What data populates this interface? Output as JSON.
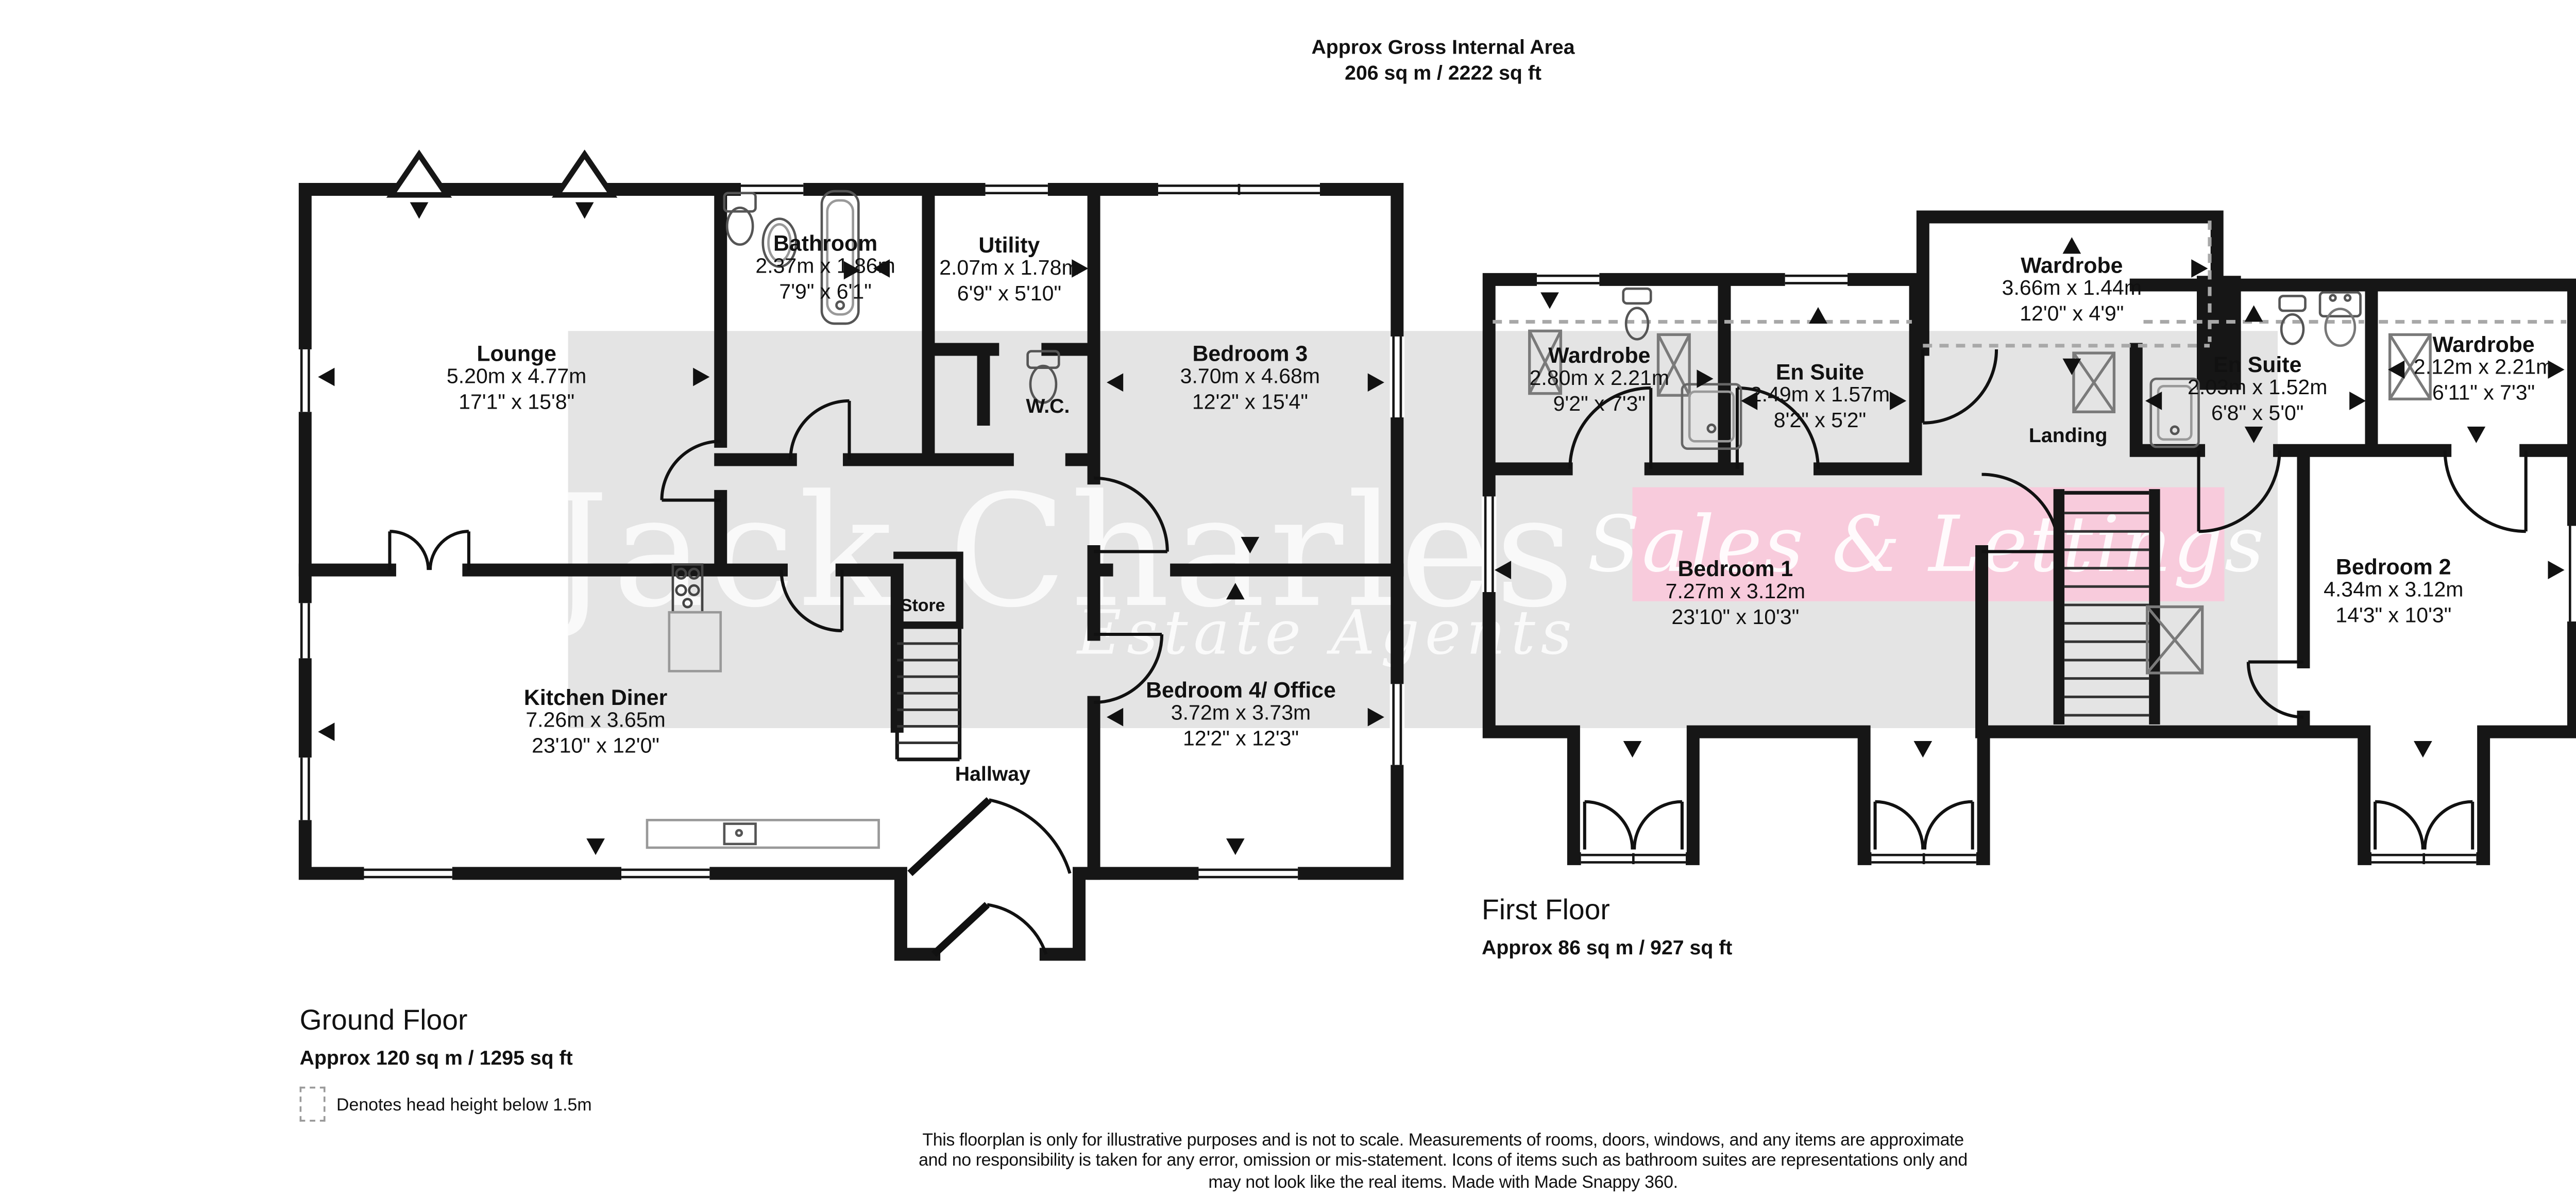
{
  "header": {
    "line1": "Approx Gross Internal Area",
    "line2": "206 sq m / 2222 sq ft"
  },
  "compass": {
    "n": "N",
    "e": "E",
    "s": "S",
    "w": "W"
  },
  "watermark": {
    "brand": "Jack Charles",
    "sub": "Estate Agents",
    "banner": "Sales & Lettings"
  },
  "ground_floor": {
    "title": "Ground Floor",
    "area": "Approx 120 sq m / 1295 sq ft",
    "rooms": {
      "lounge": {
        "name": "Lounge",
        "metric": "5.20m x 4.77m",
        "imperial": "17'1\" x 15'8\""
      },
      "bathroom": {
        "name": "Bathroom",
        "metric": "2.37m x 1.86m",
        "imperial": "7'9\" x 6'1\""
      },
      "utility": {
        "name": "Utility",
        "metric": "2.07m x 1.78m",
        "imperial": "6'9\" x 5'10\""
      },
      "wc": {
        "name": "W.C."
      },
      "bedroom3": {
        "name": "Bedroom 3",
        "metric": "3.70m x 4.68m",
        "imperial": "12'2\" x 15'4\""
      },
      "kitchen": {
        "name": "Kitchen Diner",
        "metric": "7.26m x 3.65m",
        "imperial": "23'10\" x 12'0\""
      },
      "store": {
        "name": "Store"
      },
      "hallway": {
        "name": "Hallway"
      },
      "bedroom4": {
        "name": "Bedroom 4/ Office",
        "metric": "3.72m x 3.73m",
        "imperial": "12'2\" x 12'3\""
      }
    }
  },
  "first_floor": {
    "title": "First Floor",
    "area": "Approx 86 sq m / 927 sq ft",
    "rooms": {
      "wardrobe_left": {
        "name": "Wardrobe",
        "metric": "2.80m x 2.21m",
        "imperial": "9'2\" x 7'3\""
      },
      "ensuite_left": {
        "name": "En Suite",
        "metric": "2.49m x 1.57m",
        "imperial": "8'2\" x 5'2\""
      },
      "wardrobe_top": {
        "name": "Wardrobe",
        "metric": "3.66m x 1.44m",
        "imperial": "12'0\" x 4'9\""
      },
      "landing": {
        "name": "Landing"
      },
      "ensuite_right": {
        "name": "En Suite",
        "metric": "2.03m x 1.52m",
        "imperial": "6'8\" x 5'0\""
      },
      "wardrobe_right": {
        "name": "Wardrobe",
        "metric": "2.12m x 2.21m",
        "imperial": "6'11\" x 7'3\""
      },
      "bedroom1": {
        "name": "Bedroom 1",
        "metric": "7.27m x 3.12m",
        "imperial": "23'10\" x 10'3\""
      },
      "bedroom2": {
        "name": "Bedroom 2",
        "metric": "4.34m x 3.12m",
        "imperial": "14'3\" x 10'3\""
      }
    }
  },
  "legend": {
    "label": "Denotes head height below 1.5m"
  },
  "disclaimer": {
    "line1": "This floorplan is only for illustrative purposes and is not to scale. Measurements of rooms, doors, windows, and any items are approximate",
    "line2": "and no responsibility is taken for any error, omission or mis-statement. Icons of items such as bathroom suites are representations only and",
    "line3": "may not look like the real items. Made with Made Snappy 360."
  },
  "colors": {
    "wall": "#161616",
    "band_gray": "#e4e4e4",
    "band_pink": "#f8cbdc",
    "floor": "#ffffff",
    "fixture": "#555555"
  }
}
